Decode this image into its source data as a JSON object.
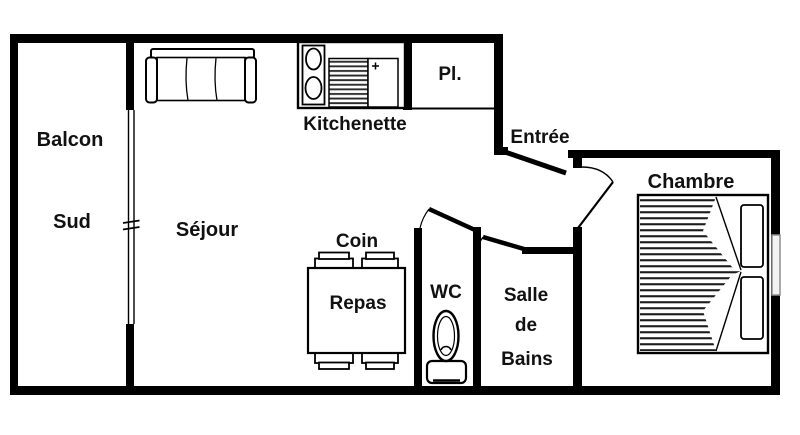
{
  "plan": {
    "type": "apartment-floor-plan",
    "language": "French"
  },
  "rooms": {
    "balcon": {
      "label": "Balcon",
      "sublabel": "Sud"
    },
    "sejour": {
      "label": "Séjour"
    },
    "kitchenette": {
      "label": "Kitchenette"
    },
    "placard": {
      "label": "Pl."
    },
    "entree": {
      "label": "Entrée"
    },
    "chambre": {
      "label": "Chambre"
    },
    "coin_repas": {
      "line1": "Coin",
      "line2": "Repas"
    },
    "wc": {
      "label": "WC"
    },
    "salle_de_bains": {
      "line1": "Salle",
      "line2": "de",
      "line3": "Bains"
    }
  },
  "colors": {
    "wall": "#000000",
    "background": "#ffffff",
    "text": "#111111",
    "window_frame": "#8f8f8f",
    "window_fill": "#f2f2f2"
  }
}
